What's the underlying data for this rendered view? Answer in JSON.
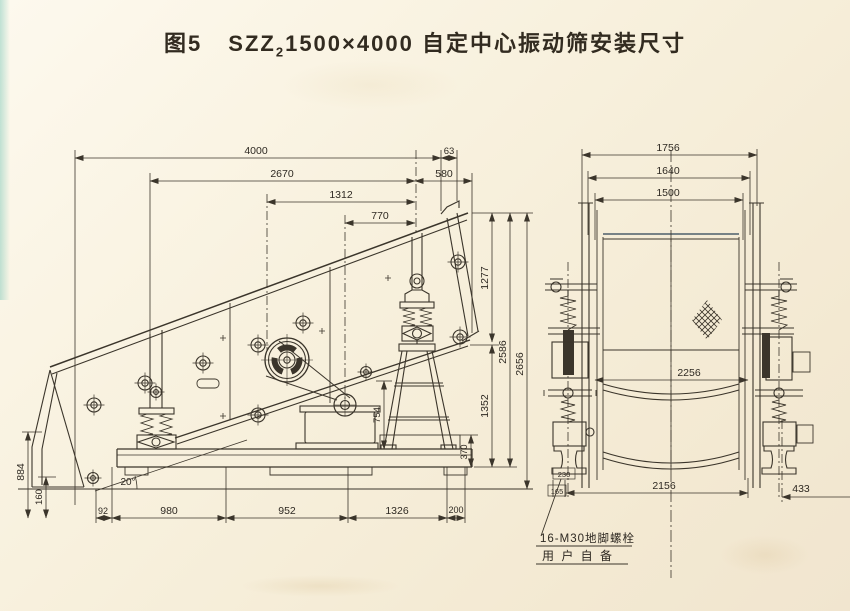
{
  "title": {
    "fig": "图5",
    "model": "SZZ",
    "sub": "2",
    "size": "1500×4000",
    "name": "自定中心振动筛安装尺寸"
  },
  "side_view": {
    "top_dims": {
      "overall": "4000",
      "d2670": "2670",
      "d1312": "1312",
      "d770": "770",
      "d63": "63",
      "d580": "580"
    },
    "right_dims": {
      "d1277": "1277",
      "d2586": "2586",
      "d2656": "2656",
      "d1352": "1352",
      "d370": "370"
    },
    "left_dims": {
      "d884": "884",
      "d160": "160"
    },
    "bottom_dims": {
      "d92": "92",
      "d980": "980",
      "d952": "952",
      "d1326": "1326",
      "d200": "200"
    },
    "misc": {
      "d754": "754",
      "angle": "20°"
    }
  },
  "end_view": {
    "top_dims": {
      "d1756": "1756",
      "d1640": "1640",
      "d1500": "1500"
    },
    "mid_dims": {
      "d2256": "2256"
    },
    "bottom_dims": {
      "d2156": "2156",
      "d433": "433",
      "d230": "230",
      "d165": "165"
    }
  },
  "notes": {
    "anchor_bolt": "16-M30地脚螺栓",
    "user_supplied": "用 户 自 备"
  },
  "colors": {
    "ink": "#3b352b",
    "paper": "#f6efdb"
  }
}
